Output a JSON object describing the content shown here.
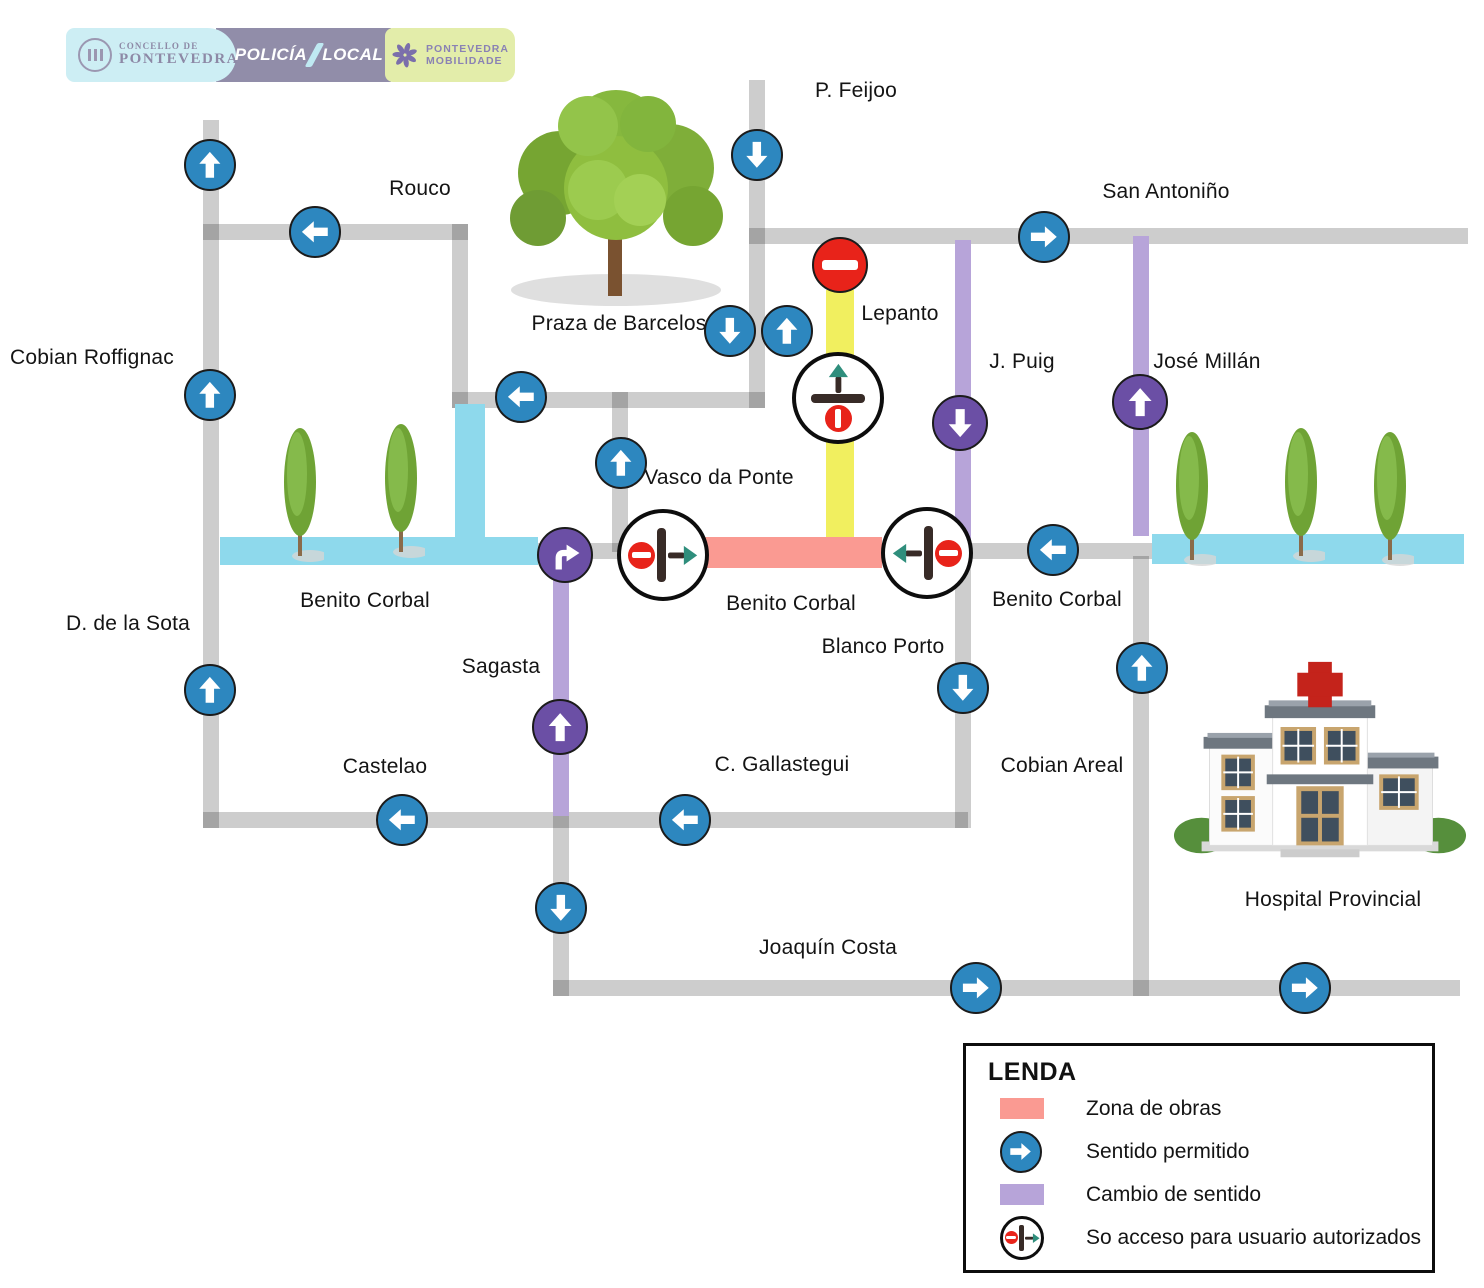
{
  "logo_bar": {
    "concello": {
      "line1": "CONCELLO DE",
      "line2": "PONTEVEDRA"
    },
    "policia": {
      "word1": "POLICÍA",
      "word2": "LOCAL"
    },
    "mobilidade": {
      "line1": "PONTEVEDRA",
      "line2": "MOBILIDADE"
    }
  },
  "map": {
    "street_labels": [
      {
        "id": "p-feijoo",
        "text": "P. Feijoo"
      },
      {
        "id": "rouco",
        "text": "Rouco"
      },
      {
        "id": "san-antonino",
        "text": "San Antoniño"
      },
      {
        "id": "cobian-roffignac",
        "text": "Cobian Roffignac"
      },
      {
        "id": "praza-de-barcelos",
        "text": "Praza de Barcelos"
      },
      {
        "id": "lepanto",
        "text": "Lepanto"
      },
      {
        "id": "j-puig",
        "text": "J. Puig"
      },
      {
        "id": "jose-millan",
        "text": "José Millán"
      },
      {
        "id": "vasco-da-ponte",
        "text": "Vasco da Ponte"
      },
      {
        "id": "benito-corbal-west",
        "text": "Benito Corbal"
      },
      {
        "id": "benito-corbal-center",
        "text": "Benito Corbal"
      },
      {
        "id": "benito-corbal-east",
        "text": "Benito Corbal"
      },
      {
        "id": "d-de-la-sota",
        "text": "D. de la Sota"
      },
      {
        "id": "sagasta",
        "text": "Sagasta"
      },
      {
        "id": "blanco-porto",
        "text": "Blanco Porto"
      },
      {
        "id": "castelao",
        "text": "Castelao"
      },
      {
        "id": "c-gallastegui",
        "text": "C. Gallastegui"
      },
      {
        "id": "cobian-areal",
        "text": "Cobian Areal"
      },
      {
        "id": "joaquin-costa",
        "text": "Joaquín Costa"
      },
      {
        "id": "hospital-provincial",
        "text": "Hospital Provincial"
      }
    ]
  },
  "legend": {
    "title": "LENDA",
    "items": [
      {
        "label": "Zona de obras"
      },
      {
        "label": "Sentido permitido"
      },
      {
        "label": "Cambio de sentido"
      },
      {
        "label": "So acceso para usuario autorizados"
      }
    ]
  },
  "colors": {
    "works_zone": "#fa9a92",
    "allowed_direction_sign": "#2d87bf",
    "direction_change_band": "#b7a4d9",
    "direction_change_sign": "#6b4fa5",
    "pedestrian_band": "#8ed9ec",
    "restricted_street_band": "#f1ef5f",
    "street": "#c9c9c9",
    "no_entry": "#e8231a",
    "authorized_arrow_head": "#2f8e7c"
  }
}
